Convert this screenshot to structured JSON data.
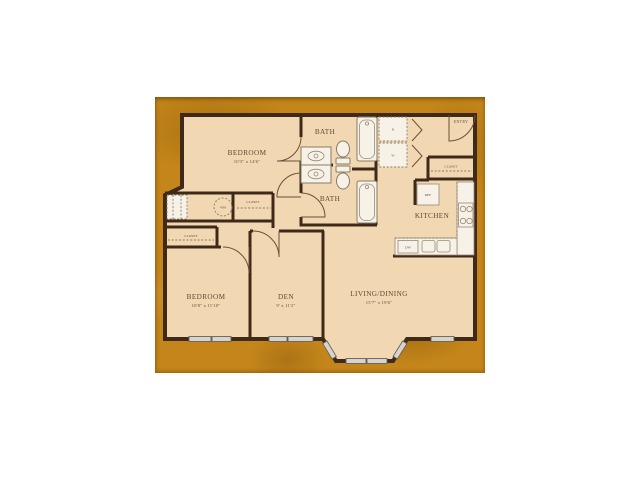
{
  "plan": {
    "type": "apartment-floor-plan",
    "colors": {
      "page_background": "#ffffff",
      "matte_gold": "#c4861a",
      "floor_cream": "#f2d8b2",
      "wall_brown": "#3f2a19",
      "fixture_fill": "#f7f2e8",
      "label_color": "#5e4934",
      "window_gray": "#d8d4cc"
    },
    "rooms": {
      "bedroom_top": {
        "name": "BEDROOM",
        "dims": "10'3\" x 14'6\""
      },
      "bath_top": {
        "name": "BATH"
      },
      "bath_bottom": {
        "name": "BATH"
      },
      "entry": {
        "name": "ENTRY"
      },
      "kitchen": {
        "name": "KITCHEN"
      },
      "bedroom_bottom": {
        "name": "BEDROOM",
        "dims": "10'8\" x 11'10\""
      },
      "den": {
        "name": "DEN",
        "dims": "9' x 11'2\""
      },
      "living_dining": {
        "name": "LIVING/DINING",
        "dims": "15'7\" x 19'6\""
      }
    },
    "fixtures": {
      "closet_hall": "CLOSET",
      "closet_bedroom": "CLOSET",
      "closet_entry": "CLOSET",
      "water_heater": "WH",
      "refrigerator": "REF",
      "dishwasher": "DW",
      "dryer": "D",
      "washer": "W"
    }
  }
}
